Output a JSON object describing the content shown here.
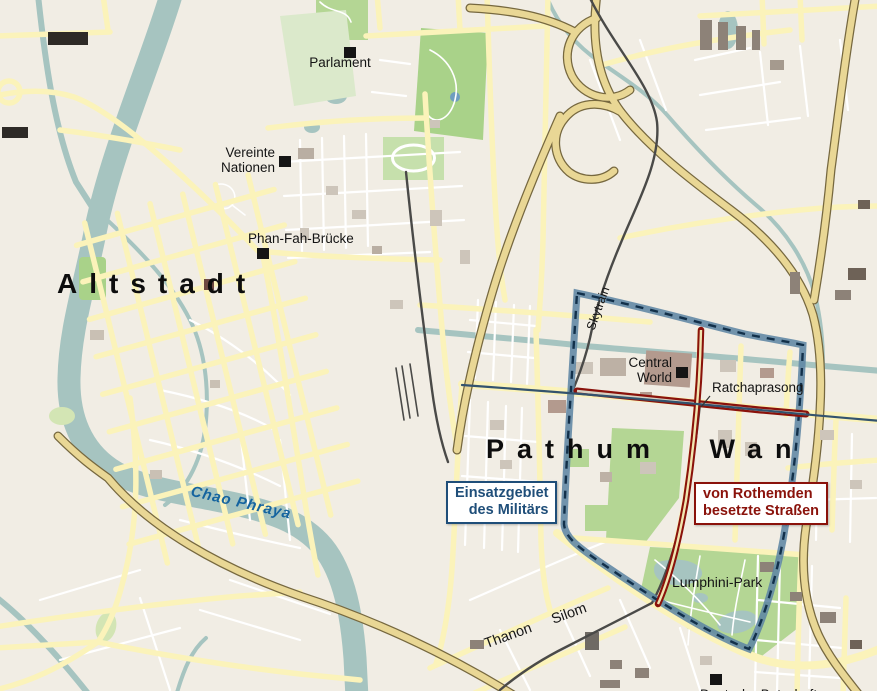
{
  "map": {
    "labels": {
      "altstadt": "Altstadt",
      "pathum_wan": "Pathum Wan",
      "parlament": "Parlament",
      "vereinte_nationen_line1": "Vereinte",
      "vereinte_nationen_line2": "Nationen",
      "phan_fah": "Phan-Fah-Brücke",
      "chao_phraya": "Chao Phraya",
      "central_world_line1": "Central",
      "central_world_line2": "World",
      "ratchaprasong": "Ratchaprasong",
      "lumphini": "Lumphini-Park",
      "thanon_silom": "Thanon Silom",
      "skytrain": "Skytrain",
      "deutsche_botschaft": "Deutsche Botschaft"
    },
    "legend": {
      "military_area_line1": "Einsatzgebiet",
      "military_area_line2": "des Militärs",
      "redshirt_line1": "von Rothemden",
      "redshirt_line2": "besetzte Straßen"
    },
    "colors": {
      "military_border": "#1f4e79",
      "redshirt_road": "#8a120b",
      "water": "#a6c4c0",
      "park": "#b4d694",
      "road_yellow": "#fbf3ba",
      "background": "#f1ede4"
    }
  }
}
